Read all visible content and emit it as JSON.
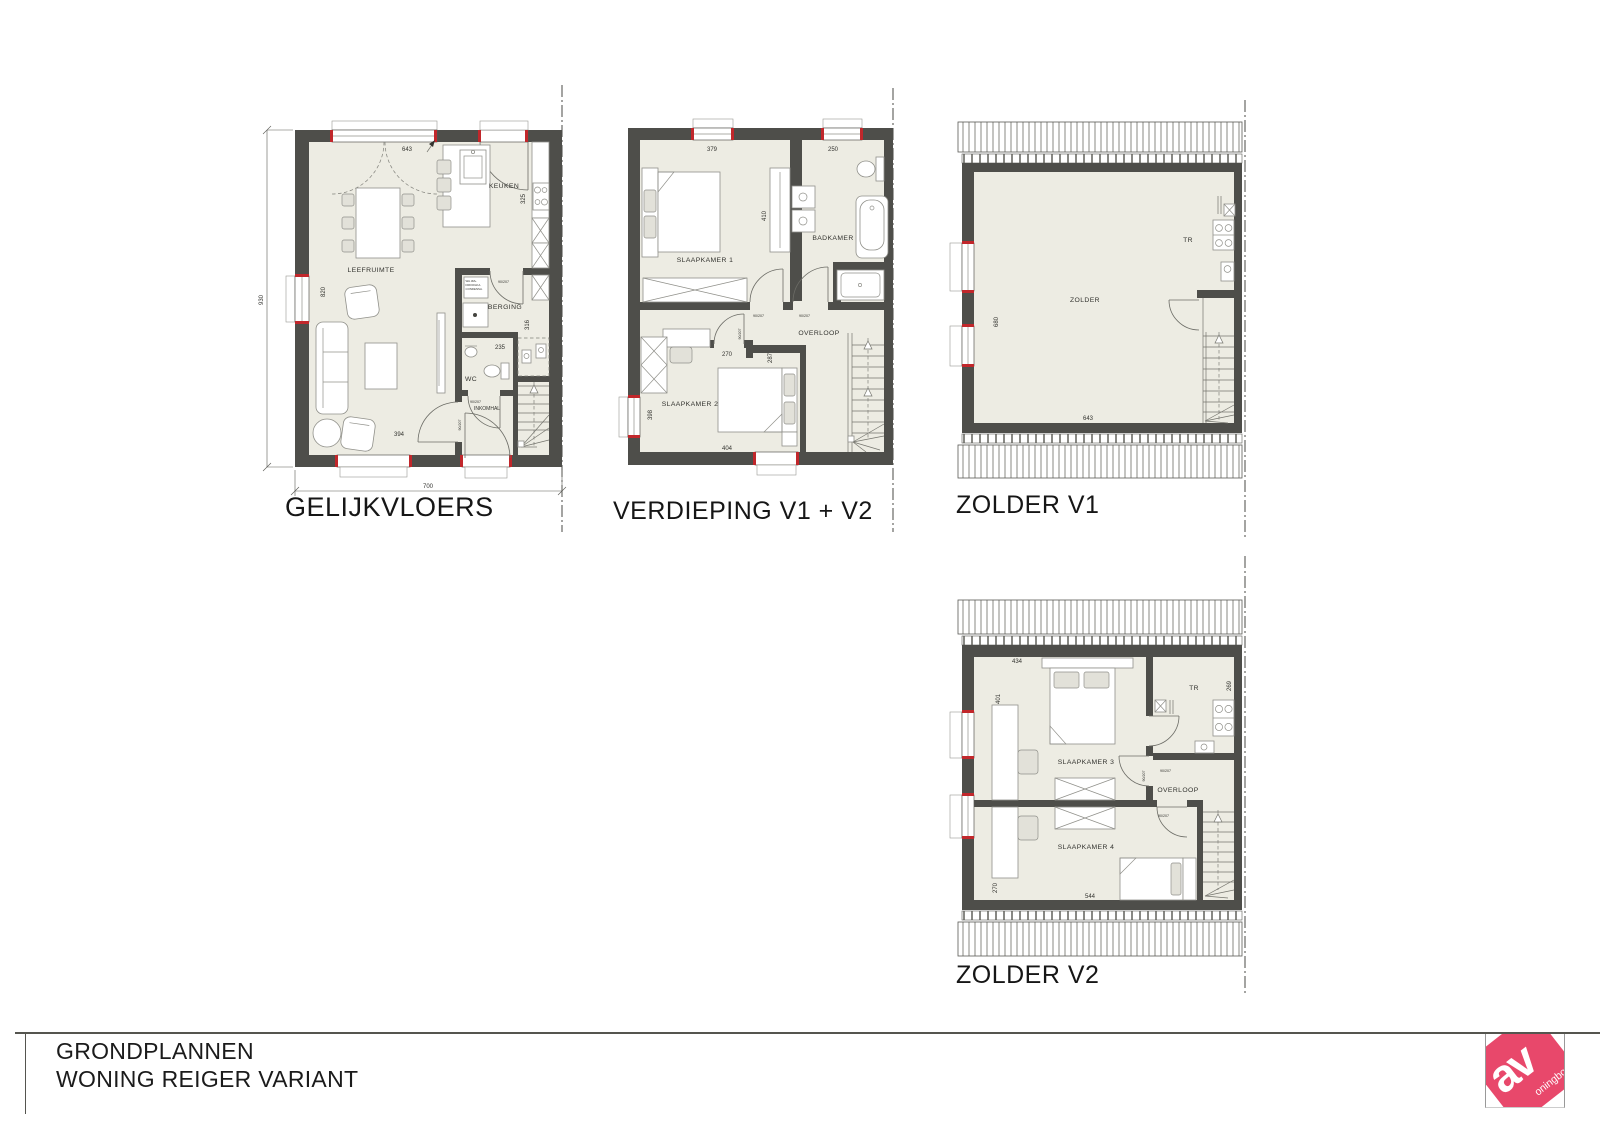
{
  "colors": {
    "wall": "#4e4e4a",
    "floor": "#edece3",
    "red": "#c1272b",
    "logo": "#e8486b"
  },
  "plans": {
    "gelijkvloers": {
      "title": "GELIJKVLOERS",
      "rooms": {
        "leefruimte": "LEEFRUIMTE",
        "keuken": "KEUKEN",
        "berging": "BERGING",
        "wc": "WC",
        "inkomhal": "INKOMHAL"
      },
      "dims": {
        "top": "643",
        "kitchen": "325",
        "inner_left": "820",
        "outer_left": "930",
        "berging": "235",
        "berging_v": "316",
        "bottom_inner": "394",
        "total": "700"
      },
      "door": "90/207",
      "washer": [
        "WA.3M+",
        "DROOGKA.",
        "CONDENSA."
      ]
    },
    "verdieping": {
      "title": "VERDIEPING V1 + V2",
      "rooms": {
        "slaapkamer1": "SLAAPKAMER 1",
        "badkamer": "BADKAMER",
        "slaapkamer2": "SLAAPKAMER 2",
        "overloop": "OVERLOOP"
      },
      "dims": {
        "slk1": "379",
        "badkamer": "250",
        "closet": "410",
        "nook_w": "270",
        "nook_h": "287",
        "window": "398",
        "slk2": "404"
      },
      "door": "90/207"
    },
    "zolder_v1": {
      "title": "ZOLDER V1",
      "rooms": {
        "zolder": "ZOLDER",
        "tr": "TR"
      },
      "dims": {
        "left": "680",
        "bottom": "643"
      }
    },
    "zolder_v2": {
      "title": "ZOLDER V2",
      "rooms": {
        "slaapkamer3": "SLAAPKAMER 3",
        "slaapkamer4": "SLAAPKAMER 4",
        "overloop": "OVERLOOP",
        "tr": "TR"
      },
      "dims": {
        "top": "434",
        "left": "401",
        "right": "269",
        "left2": "270",
        "bottom": "544"
      },
      "door": "90/207"
    }
  },
  "titleblock": {
    "line1": "GRONDPLANNEN",
    "line2": "WONING REIGER VARIANT"
  },
  "logo": {
    "big": "av",
    "small": "oningbo"
  }
}
